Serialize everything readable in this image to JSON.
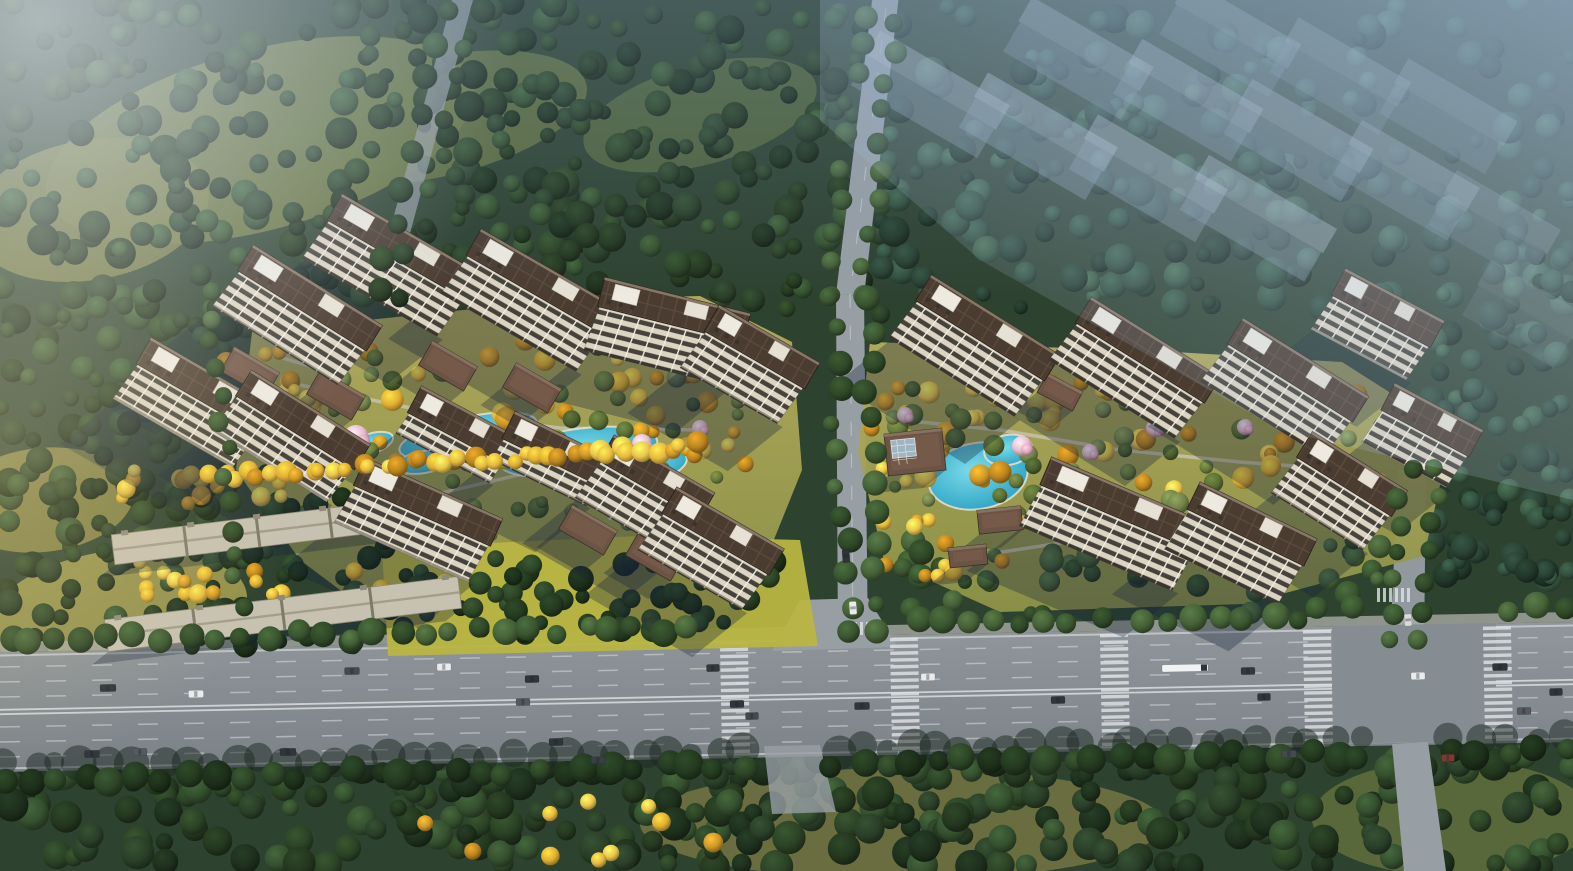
{
  "scene": {
    "width": 1573,
    "height": 871,
    "palette": {
      "base_forest": "#2e4230",
      "lawn_top": "#b6ae5e",
      "lawn_bottom": "#8e9348",
      "lawn_bright": "#b9b542",
      "pool_center": "#7adbe9",
      "pool_edge": "#2da2c3",
      "pool_deck": "#e9e2cf",
      "asphalt_top": "#90969b",
      "asphalt_bottom": "#7b8287",
      "minor_road": "#979ea4",
      "sidewalk": "#a7aaa5",
      "lane_line": "#d7dadc",
      "facade_base": "#dcd4c2",
      "facade_window": "#46423b",
      "facade_mullion": "#f1ede1",
      "roof_dark": "#4b3c31",
      "roof_line": "#5c4c3e",
      "roof_parapet": "#8d7c6a",
      "roof_core_white": "#eeeae0",
      "villa_roof": "#6b5345",
      "villa_ridge": "#86705f",
      "lowrise_roof": "#c7c1b1",
      "lowrise_edge": "#8f8977",
      "ghost_roof": "#b7c4d2",
      "ghost_facade": "#8fa2b5",
      "shadow": "rgba(25,36,58,0.33)",
      "tree_shadow_blob": "rgba(28,40,34,0.5)",
      "haze": "173,195,220",
      "glow": "244,247,250",
      "warm_glow": "236,217,160",
      "top_tint": "125,155,190",
      "blossom_a": "#e7bac9",
      "blossom_b": "#dca6b8",
      "skylight": "#9fb6c2"
    },
    "tree_palettes": {
      "forest": [
        "#24371f",
        "#2c4326",
        "#1e301d",
        "#35502f",
        "#2a3f28"
      ],
      "forestBlue": [
        "#2a4234",
        "#33503e",
        "#223729",
        "#3b5a44"
      ],
      "gold": [
        "#dfae33",
        "#e9c44d",
        "#cb9628",
        "#b9841f",
        "#e5b83f"
      ],
      "green": [
        "#5a6d34",
        "#66783b",
        "#4a5d2e",
        "#72814a"
      ],
      "street": [
        "#2f4727",
        "#3a5530",
        "#456037"
      ],
      "streetDark": [
        "#243a20",
        "#2d4527",
        "#1d2f1a"
      ]
    },
    "meadows": [
      [
        260,
        140,
        220,
        90,
        -15,
        "#6d7841",
        0.9
      ],
      [
        90,
        210,
        120,
        70,
        -10,
        "#787d45",
        0.85
      ],
      [
        430,
        118,
        160,
        60,
        -12,
        "#657440",
        0.8
      ],
      [
        700,
        115,
        120,
        50,
        -15,
        "#5d6f3e",
        0.7
      ],
      [
        118,
        612,
        130,
        62,
        -8,
        "#a09a50",
        0.9
      ],
      [
        42,
        500,
        92,
        52,
        -6,
        "#8d8a48",
        0.85
      ],
      [
        902,
        824,
        262,
        56,
        0,
        "#6e7040",
        0.95
      ],
      [
        1452,
        818,
        140,
        58,
        0,
        "#5e6d3c",
        0.9
      ]
    ],
    "lawns": {
      "west": "252,332 560,300 700,296 792,342 802,470 748,604 566,636 404,638 300,560 236,470",
      "east": "870,342 1140,350 1342,362 1452,432 1424,556 1244,604 1000,612 884,560 858,452",
      "west_south": "382,548 640,536 800,540 818,646 560,652 388,656"
    },
    "tree_zones": [
      {
        "r": [
          0,
          0,
          580,
          330
        ],
        "n": 230,
        "c": "forest",
        "rad": [
          7,
          16
        ]
      },
      {
        "r": [
          0,
          290,
          240,
          380
        ],
        "n": 120,
        "c": "forest",
        "rad": [
          7,
          15
        ]
      },
      {
        "r": [
          540,
          0,
          350,
          320
        ],
        "n": 140,
        "c": "forest",
        "rad": [
          7,
          15
        ]
      },
      {
        "r": [
          880,
          0,
          693,
          310
        ],
        "n": 210,
        "c": "forestBlue",
        "rad": [
          7,
          16
        ]
      },
      {
        "r": [
          1430,
          250,
          143,
          330
        ],
        "n": 90,
        "c": "forestBlue",
        "rad": [
          7,
          15
        ]
      },
      {
        "r": [
          0,
          756,
          1573,
          112
        ],
        "n": 300,
        "c": "forest",
        "rad": [
          8,
          17
        ]
      },
      {
        "r": [
          285,
          325,
          480,
          148
        ],
        "n": 58,
        "c": "gold",
        "rad": [
          6,
          12
        ]
      },
      {
        "r": [
          300,
          338,
          460,
          200
        ],
        "n": 55,
        "c": "green",
        "rad": [
          6,
          11
        ]
      },
      {
        "r": [
          180,
          348,
          130,
          95
        ],
        "n": 16,
        "c": "gold",
        "rad": [
          6,
          11
        ]
      },
      {
        "r": [
          395,
          556,
          400,
          80
        ],
        "n": 52,
        "c": "streetDark",
        "rad": [
          7,
          13
        ]
      },
      {
        "r": [
          868,
          378,
          530,
          115
        ],
        "n": 55,
        "c": "gold",
        "rad": [
          6,
          12
        ]
      },
      {
        "r": [
          880,
          388,
          520,
          135
        ],
        "n": 45,
        "c": "green",
        "rad": [
          6,
          11
        ]
      },
      {
        "r": [
          900,
          540,
          480,
          75
        ],
        "n": 50,
        "c": "street",
        "rad": [
          7,
          13
        ]
      },
      {
        "r": [
          880,
          516,
          150,
          64
        ],
        "n": 13,
        "c": "gold",
        "rad": [
          6,
          11
        ]
      },
      {
        "r": [
          95,
          470,
          330,
          180
        ],
        "n": 70,
        "c": "streetDark",
        "rad": [
          7,
          13
        ]
      },
      {
        "r": [
          120,
          470,
          300,
          40
        ],
        "n": 20,
        "c": "gold",
        "rad": [
          6,
          10
        ]
      },
      {
        "r": [
          130,
          560,
          320,
          36
        ],
        "n": 18,
        "c": "gold",
        "rad": [
          6,
          10
        ]
      },
      {
        "r": [
          410,
          790,
          380,
          70
        ],
        "n": 10,
        "c": "gold",
        "rad": [
          6,
          10
        ]
      }
    ],
    "tree_rows": [
      {
        "a": [
          212,
          476
        ],
        "b": [
          695,
          446
        ],
        "n": 40,
        "c": "gold",
        "rad": [
          7,
          11
        ]
      },
      {
        "a": [
          862,
          16
        ],
        "b": [
          826,
          290
        ],
        "n": 10,
        "c": "street",
        "rad": [
          8,
          12
        ]
      },
      {
        "a": [
          898,
          20
        ],
        "b": [
          864,
          292
        ],
        "n": 10,
        "c": "street",
        "rad": [
          8,
          12
        ]
      },
      {
        "a": [
          832,
          300
        ],
        "b": [
          848,
          634
        ],
        "n": 12,
        "c": "street",
        "rad": [
          8,
          13
        ]
      },
      {
        "a": [
          866,
          300
        ],
        "b": [
          882,
          634
        ],
        "n": 12,
        "c": "street",
        "rad": [
          8,
          13
        ]
      },
      {
        "a": [
          448,
          8
        ],
        "b": [
          374,
          294
        ],
        "n": 9,
        "c": "forest",
        "rad": [
          8,
          13
        ]
      },
      {
        "a": [
          478,
          8
        ],
        "b": [
          400,
          294
        ],
        "n": 9,
        "c": "forest",
        "rad": [
          8,
          13
        ]
      },
      {
        "a": [
          1408,
          470
        ],
        "b": [
          1384,
          640
        ],
        "n": 7,
        "c": "street",
        "rad": [
          8,
          12
        ]
      },
      {
        "a": [
          1436,
          470
        ],
        "b": [
          1418,
          640
        ],
        "n": 7,
        "c": "street",
        "rad": [
          8,
          12
        ]
      },
      {
        "a": [
          210,
          318
        ],
        "b": [
          242,
          606
        ],
        "n": 12,
        "c": "street",
        "rad": [
          7,
          11
        ]
      },
      {
        "a": [
          8,
          641
        ],
        "b": [
          688,
          628
        ],
        "n": 27,
        "c": "street",
        "rad": [
          9,
          14
        ]
      },
      {
        "a": [
          916,
          624
        ],
        "b": [
          1096,
          621
        ],
        "n": 8,
        "c": "street",
        "rad": [
          9,
          14
        ]
      },
      {
        "a": [
          1136,
          620
        ],
        "b": [
          1300,
          617
        ],
        "n": 7,
        "c": "street",
        "rad": [
          9,
          14
        ]
      },
      {
        "a": [
          1506,
          610
        ],
        "b": [
          1566,
          609
        ],
        "n": 3,
        "c": "street",
        "rad": [
          9,
          14
        ]
      },
      {
        "a": [
          8,
          780
        ],
        "b": [
          744,
          766
        ],
        "n": 29,
        "c": "streetDark",
        "rad": [
          10,
          16
        ]
      },
      {
        "a": [
          834,
          764
        ],
        "b": [
          1360,
          754
        ],
        "n": 21,
        "c": "streetDark",
        "rad": [
          10,
          16
        ]
      },
      {
        "a": [
          1452,
          752
        ],
        "b": [
          1566,
          750
        ],
        "n": 5,
        "c": "streetDark",
        "rad": [
          10,
          16
        ]
      }
    ],
    "shadow_rows": [
      {
        "a": [
          8,
          766
        ],
        "b": [
          744,
          752
        ],
        "n": 30,
        "rad": [
          10,
          18
        ]
      },
      {
        "a": [
          834,
          750
        ],
        "b": [
          1360,
          740
        ],
        "n": 22,
        "rad": [
          10,
          18
        ]
      },
      {
        "a": [
          1452,
          740
        ],
        "b": [
          1566,
          738
        ],
        "n": 5,
        "rad": [
          10,
          16
        ]
      }
    ],
    "ponds_west": [
      [
        468,
        436,
        70,
        19,
        -12
      ],
      [
        578,
        452,
        80,
        23,
        -8
      ],
      [
        650,
        468,
        38,
        15,
        -16
      ],
      [
        424,
        462,
        28,
        11,
        -10
      ],
      [
        370,
        444,
        24,
        10,
        -18
      ]
    ],
    "pools_east": [
      [
        978,
        476,
        50,
        33,
        -10
      ],
      [
        1008,
        450,
        24,
        15,
        -10
      ]
    ],
    "blossoms": [
      [
        356,
        438,
        13
      ],
      [
        344,
        452,
        10
      ],
      [
        445,
        436,
        11
      ],
      [
        486,
        464,
        8
      ],
      [
        642,
        444,
        10
      ],
      [
        700,
        428,
        8
      ],
      [
        672,
        452,
        7
      ],
      [
        1022,
        446,
        10
      ],
      [
        1090,
        452,
        8
      ],
      [
        1155,
        428,
        9
      ],
      [
        1245,
        427,
        8
      ],
      [
        905,
        415,
        8
      ]
    ],
    "paths": [
      [
        300,
        385,
        430,
        412,
        560,
        428,
        700,
        430
      ],
      [
        420,
        498,
        540,
        470,
        640,
        462
      ],
      [
        262,
        352,
        330,
        372
      ],
      [
        620,
        432,
        610,
        520
      ],
      [
        900,
        420,
        1000,
        430,
        1120,
        450,
        1240,
        462,
        1350,
        470
      ],
      [
        950,
        560,
        1080,
        540,
        1200,
        530
      ]
    ],
    "roads": {
      "center_upper": "873,-5 899,-5 864,296 836,294",
      "center_lower": "836,294 864,296 868,648 838,648",
      "right_upper": "1398,470 1426,470 1424,648 1390,648",
      "top_left": "452,0 473,0 392,300 372,297",
      "right_stub": "1392,744 1428,742 1446,871 1404,871",
      "center_stub": "764,746 820,745 836,812 772,814",
      "center_mouth": "800,600 868,598 898,647 772,651",
      "intersection": "1332,626 1496,623 1496,741 1332,744"
    },
    "highway": {
      "surface": "0,652 1573,622 1573,742 0,772",
      "sidewalk": "0,642 1573,612 1573,622 0,652",
      "lane_count": 7,
      "crosswalks": [
        735,
        905,
        1115,
        1318,
        1498
      ],
      "side_crosswalks": [
        [
          1377,
          588,
          1412,
          592
        ],
        [
          842,
          622,
          876,
          625
        ]
      ]
    },
    "towers_west": [
      [
        310,
        298,
        152,
        32,
        44
      ],
      [
        205,
        386,
        142,
        30,
        42
      ],
      [
        303,
        420,
        140,
        32,
        42
      ],
      [
        404,
        247,
        160,
        30,
        46
      ],
      [
        543,
        282,
        160,
        30,
        46
      ],
      [
        674,
        310,
        150,
        14,
        46
      ],
      [
        762,
        347,
        116,
        30,
        44
      ],
      [
        463,
        425,
        110,
        28,
        24
      ],
      [
        558,
        449,
        110,
        26,
        24
      ],
      [
        428,
        502,
        150,
        24,
        42
      ],
      [
        657,
        477,
        116,
        30,
        44
      ],
      [
        723,
        531,
        124,
        30,
        44
      ]
    ],
    "towers_east": [
      [
        988,
        328,
        152,
        32,
        46
      ],
      [
        1148,
        350,
        152,
        32,
        46
      ],
      [
        1298,
        370,
        148,
        32,
        46
      ],
      [
        1388,
        308,
        112,
        28,
        40
      ],
      [
        1124,
        504,
        170,
        23,
        46
      ],
      [
        1252,
        524,
        130,
        26,
        46
      ],
      [
        1352,
        474,
        112,
        32,
        44
      ],
      [
        1432,
        420,
        100,
        28,
        38
      ]
    ],
    "ghost_towers": [
      [
        938,
        80,
        150,
        30,
        0.42
      ],
      [
        1046,
        122,
        150,
        30,
        0.44
      ],
      [
        1156,
        164,
        150,
        30,
        0.42
      ],
      [
        1266,
        204,
        148,
        30,
        0.4
      ],
      [
        1086,
        44,
        140,
        30,
        0.36
      ],
      [
        1196,
        86,
        140,
        30,
        0.38
      ],
      [
        1306,
        126,
        140,
        30,
        0.36
      ],
      [
        1414,
        166,
        136,
        30,
        0.32
      ],
      [
        1238,
        24,
        130,
        30,
        0.3
      ],
      [
        1348,
        62,
        130,
        30,
        0.28
      ],
      [
        1456,
        102,
        126,
        30,
        0.26
      ],
      [
        1502,
        212,
        120,
        30,
        0.22
      ],
      [
        1532,
        300,
        110,
        30,
        0.17
      ]
    ],
    "villas_west": [
      [
        250,
        372,
        52,
        28,
        30
      ],
      [
        336,
        395,
        52,
        28,
        30
      ],
      [
        448,
        366,
        52,
        28,
        30
      ],
      [
        532,
        388,
        52,
        28,
        30
      ],
      [
        588,
        530,
        52,
        28,
        30
      ],
      [
        655,
        556,
        52,
        28,
        30
      ],
      [
        162,
        392,
        52,
        28,
        30
      ]
    ],
    "villas_east": [
      [
        915,
        452,
        58,
        42,
        -6
      ],
      [
        1000,
        520,
        44,
        24,
        -6
      ],
      [
        968,
        556,
        38,
        20,
        -6
      ],
      [
        1060,
        392,
        40,
        22,
        28
      ]
    ],
    "lowrise_rows": [
      [
        258,
        532,
        292,
        30,
        -7
      ],
      [
        283,
        614,
        356,
        32,
        -7
      ]
    ],
    "cars": [
      [
        108,
        688,
        16,
        "#2f353a"
      ],
      [
        196,
        694,
        15,
        "#e9ebec"
      ],
      [
        92,
        754,
        15,
        "#33383d"
      ],
      [
        140,
        752,
        14,
        "#555b60"
      ],
      [
        288,
        752,
        16,
        "#2f353a"
      ],
      [
        352,
        671,
        15,
        "#454a50"
      ],
      [
        444,
        667,
        14,
        "#e9ebec"
      ],
      [
        532,
        679,
        14,
        "#2f353a"
      ],
      [
        523,
        702,
        14,
        "#55595e"
      ],
      [
        556,
        742,
        14,
        "#2f353a"
      ],
      [
        598,
        760,
        14,
        "#3a3f45"
      ],
      [
        713,
        668,
        13,
        "#33383d"
      ],
      [
        737,
        704,
        14,
        "#2f353a"
      ],
      [
        752,
        716,
        13,
        "#44494e"
      ],
      [
        862,
        706,
        15,
        "#2f353a"
      ],
      [
        928,
        677,
        14,
        "#e9ebec"
      ],
      [
        1058,
        700,
        14,
        "#2f353a"
      ],
      [
        1185,
        668,
        46,
        "#f0f2f3"
      ],
      [
        1248,
        671,
        14,
        "#33383d"
      ],
      [
        1264,
        697,
        13,
        "#2f353a"
      ],
      [
        1289,
        754,
        15,
        "#45494e"
      ],
      [
        1418,
        676,
        14,
        "#e9ebec"
      ],
      [
        1500,
        667,
        15,
        "#2f353a"
      ],
      [
        1524,
        711,
        14,
        "#55595e"
      ],
      [
        1556,
        692,
        13,
        "#2f353a"
      ],
      [
        1448,
        758,
        13,
        "#7d3a32"
      ]
    ],
    "vertical_cars": [
      [
        846,
        556,
        13,
        "#2e3338"
      ],
      [
        853,
        608,
        13,
        "#e8eaec"
      ],
      [
        1408,
        620,
        12,
        "#d8dadb"
      ]
    ]
  }
}
